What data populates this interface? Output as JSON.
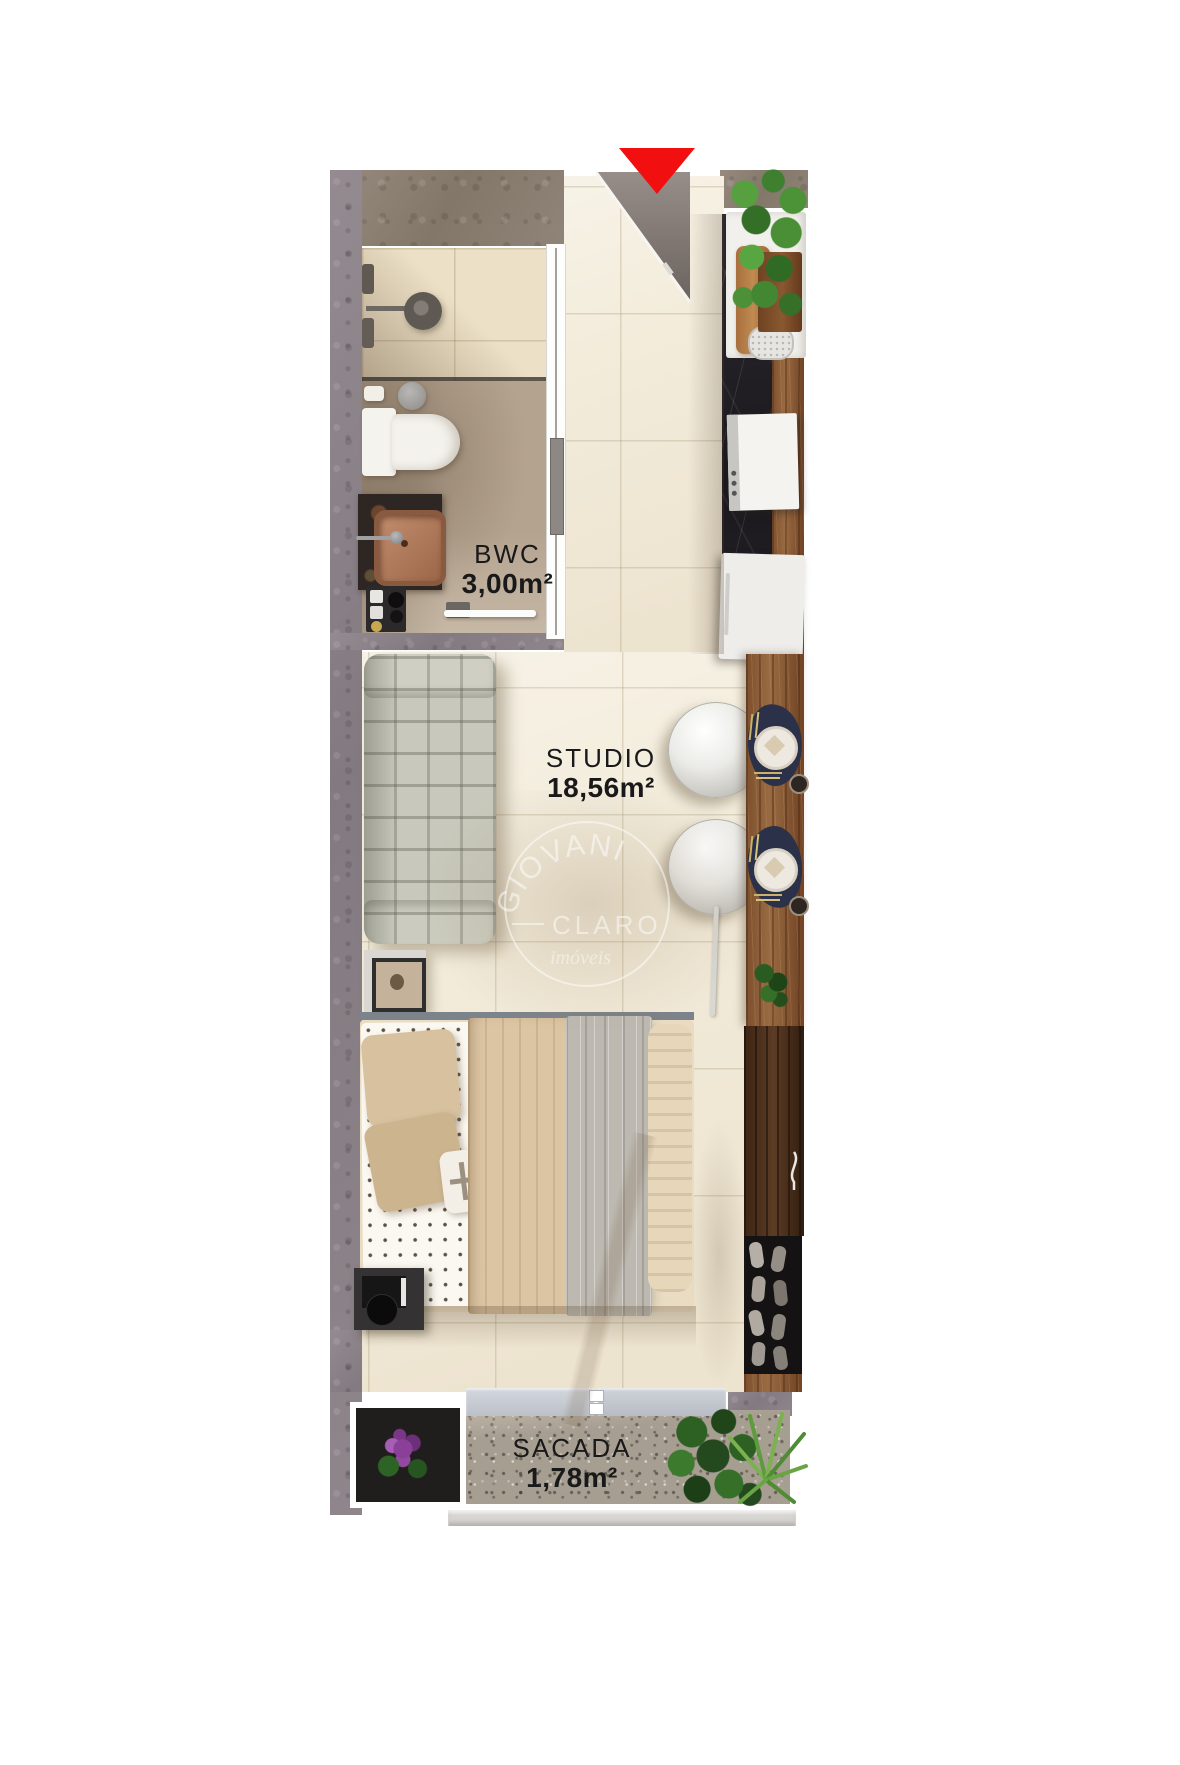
{
  "rooms": [
    {
      "id": "bwc",
      "label": "BWC",
      "area": "3,00m²"
    },
    {
      "id": "studio",
      "label": "STUDIO",
      "area": "18,56m²"
    },
    {
      "id": "sacada",
      "label": "SACADA",
      "area": "1,78m²"
    }
  ],
  "watermark": {
    "top": "GIOVANI",
    "middle": "CLARO",
    "bottom": "imóveis"
  },
  "icons": {
    "entrance": "entrance-arrow"
  },
  "colors": {
    "entrance_arrow": "#f10f0f",
    "wall_concrete": "#8c8389",
    "studio_floor": "#f3ecdb",
    "balcony_floor": "#a79e92",
    "counter_wood": "#8a5c39",
    "kitchen_floor_marble": "#232125",
    "placemat_navy": "#2b3148"
  }
}
